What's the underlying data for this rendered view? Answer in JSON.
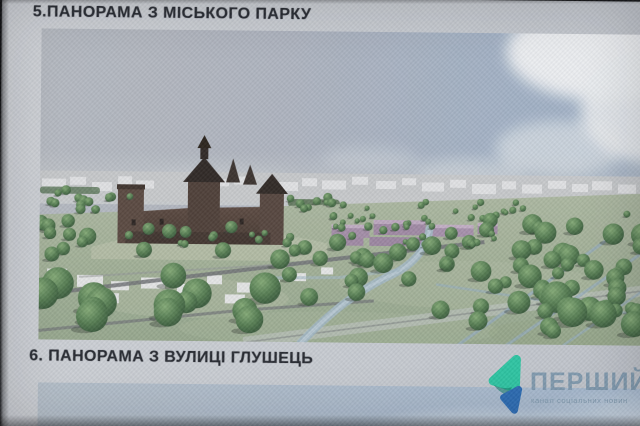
{
  "titles": {
    "panel5": "5.ПАНОРАМА З МІСЬКОГО ПАРКУ",
    "panel6": "6. ПАНОРАМА З ВУЛИЦІ ГЛУШЕЦЬ"
  },
  "watermark": {
    "brand": "ПЕРШИЙ",
    "tagline": "канал соціальних новин",
    "icon": "play-ribbon-icon"
  },
  "palette": {
    "board": "#c7cbd1",
    "title_text": "#272a31",
    "sky_left": "#b2b7bf",
    "sky_right": "#98aec9",
    "cloud_white": "#edeff1",
    "ground_green": "#a2b295",
    "tree_green": "#4b7b47",
    "tree_dark": "#2c5130",
    "castle_brown": "#4f3d34",
    "castle_roof": "#2e2521",
    "massing_white": "#e2e3e5",
    "highlight_purple": "#a688ac",
    "road_gray": "#6e7276",
    "water_blue": "#9db7c7",
    "logo_teal": "#2fc4a2",
    "logo_blue": "#2d6cb3",
    "logo_text": "#7e98ad"
  },
  "scene": {
    "description": "3D masterplan panorama: medieval castle on a hill, city park with round trees, river and canals, white massing blocks on horizon, purple highlighted development",
    "tree_clusters": [
      {
        "x0": 4,
        "x1": 92,
        "y0": 160,
        "y1": 184,
        "rmin": 3,
        "rmax": 5.5,
        "count": 14,
        "seed": 11
      },
      {
        "x0": 0,
        "x1": 235,
        "y0": 192,
        "y1": 234,
        "rmin": 5,
        "rmax": 9,
        "count": 16,
        "seed": 22
      },
      {
        "x0": 0,
        "x1": 235,
        "y0": 238,
        "y1": 298,
        "rmin": 10,
        "rmax": 17,
        "count": 14,
        "seed": 33
      },
      {
        "x0": 88,
        "x1": 252,
        "y0": 200,
        "y1": 214,
        "rmin": 3,
        "rmax": 5,
        "count": 10,
        "seed": 44
      },
      {
        "x0": 235,
        "x1": 420,
        "y0": 208,
        "y1": 268,
        "rmin": 6,
        "rmax": 10,
        "count": 18,
        "seed": 55
      },
      {
        "x0": 286,
        "x1": 458,
        "y0": 184,
        "y1": 212,
        "rmin": 2.5,
        "rmax": 4.5,
        "count": 32,
        "seed": 66
      },
      {
        "x0": 400,
        "x1": 618,
        "y0": 186,
        "y1": 298,
        "rmin": 6,
        "rmax": 12,
        "count": 48,
        "seed": 77
      },
      {
        "x0": 478,
        "x1": 618,
        "y0": 258,
        "y1": 304,
        "rmin": 11,
        "rmax": 16,
        "count": 8,
        "seed": 88
      },
      {
        "x0": 250,
        "x1": 305,
        "y0": 166,
        "y1": 180,
        "rmin": 3,
        "rmax": 5,
        "count": 9,
        "seed": 99
      },
      {
        "x0": 306,
        "x1": 620,
        "y0": 168,
        "y1": 182,
        "rmin": 2.5,
        "rmax": 4,
        "count": 14,
        "seed": 111
      }
    ],
    "horizon_blocks": [
      [
        2,
        150,
        24,
        10
      ],
      [
        30,
        148,
        16,
        8
      ],
      [
        52,
        153,
        20,
        9
      ],
      [
        78,
        147,
        14,
        8
      ],
      [
        96,
        151,
        18,
        8
      ],
      [
        150,
        145,
        22,
        10
      ],
      [
        176,
        149,
        13,
        7
      ],
      [
        194,
        146,
        17,
        8
      ],
      [
        238,
        151,
        20,
        9
      ],
      [
        262,
        147,
        15,
        8
      ],
      [
        282,
        149,
        24,
        9
      ],
      [
        312,
        145,
        16,
        8
      ],
      [
        336,
        149,
        20,
        8
      ],
      [
        362,
        146,
        14,
        7
      ],
      [
        382,
        150,
        22,
        9
      ],
      [
        410,
        147,
        16,
        8
      ],
      [
        432,
        151,
        24,
        10
      ],
      [
        462,
        148,
        14,
        8
      ],
      [
        482,
        151,
        20,
        9
      ],
      [
        508,
        147,
        18,
        8
      ],
      [
        532,
        150,
        16,
        8
      ],
      [
        552,
        147,
        20,
        9
      ],
      [
        578,
        150,
        18,
        9
      ],
      [
        600,
        148,
        20,
        9
      ]
    ],
    "mid_blocks": [
      [
        8,
        240,
        20,
        10
      ],
      [
        38,
        246,
        26,
        12
      ],
      [
        72,
        252,
        18,
        9
      ],
      [
        102,
        248,
        24,
        11
      ],
      [
        138,
        254,
        20,
        10
      ],
      [
        168,
        245,
        15,
        9
      ],
      [
        198,
        252,
        22,
        10
      ],
      [
        228,
        249,
        13,
        8
      ],
      [
        58,
        264,
        22,
        10
      ],
      [
        118,
        266,
        17,
        9
      ],
      [
        186,
        264,
        20,
        9
      ],
      [
        252,
        242,
        15,
        8
      ],
      [
        282,
        236,
        12,
        7
      ]
    ]
  }
}
